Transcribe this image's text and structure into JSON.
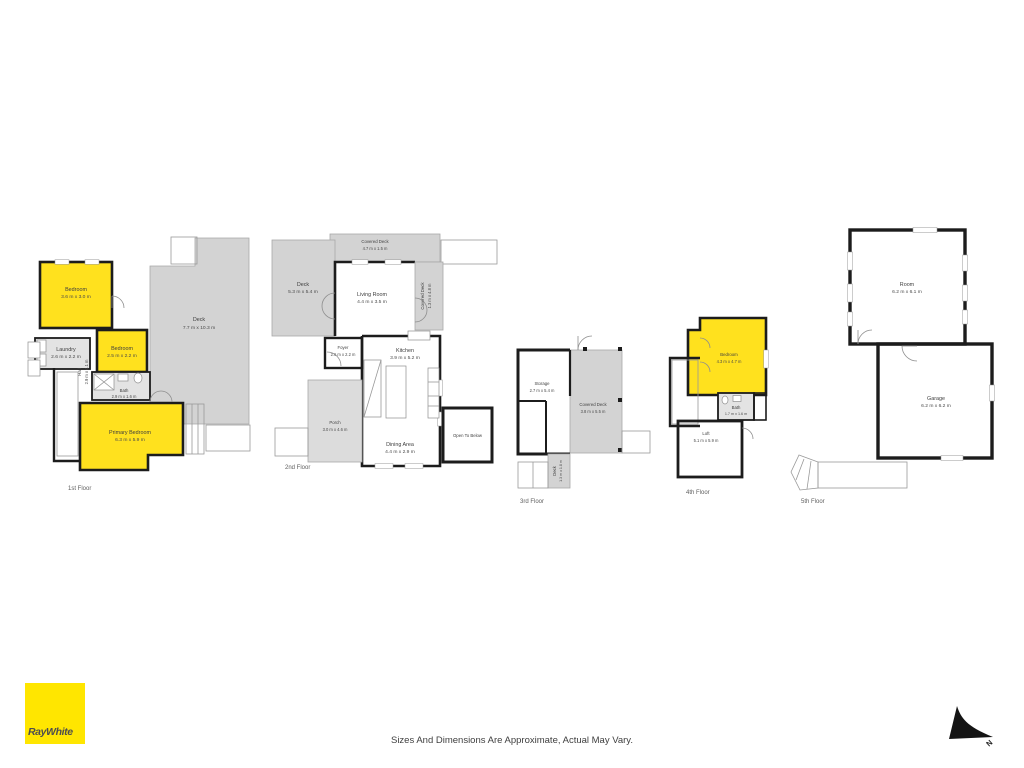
{
  "page": {
    "brand": "RayWhite",
    "disclaimer": "Sizes And Dimensions Are Approximate, Actual May Vary.",
    "north_label": "N",
    "colors": {
      "room_highlight": "#FFE11E",
      "deck_gray": "#D3D3D3",
      "wall_black": "#1C1C1C",
      "brand_yellow": "#FFE600",
      "brand_text": "#4D4D4F"
    }
  },
  "floors": [
    {
      "label": "1st Floor",
      "rooms": [
        {
          "name": "Bedroom",
          "dims": "3.6 m x 3.0 m"
        },
        {
          "name": "Deck",
          "dims": "7.7 m x 10.3 m"
        },
        {
          "name": "Laundry",
          "dims": "2.6 m x 2.2 m"
        },
        {
          "name": "Bedroom",
          "dims": "2.5 m x 2.2 m"
        },
        {
          "name": "Hall",
          "dims": "2.9 m x 4.1 m"
        },
        {
          "name": "Bath",
          "dims": "2.9 m x 1.6 m"
        },
        {
          "name": "Primary Bedroom",
          "dims": "6.3 m x 5.9 m"
        }
      ]
    },
    {
      "label": "2nd Floor",
      "rooms": [
        {
          "name": "Covered Deck",
          "dims": "4.7 m x 1.5 m"
        },
        {
          "name": "Deck",
          "dims": "5.3 m x 5.4 m"
        },
        {
          "name": "Living Room",
          "dims": "4.4 m x 3.5 m"
        },
        {
          "name": "Covered Deck",
          "dims": "1.3 m x 4.8 m"
        },
        {
          "name": "Foyer",
          "dims": "2.6 m x 2.2 m"
        },
        {
          "name": "Kitchen",
          "dims": "3.9 m x 5.2 m"
        },
        {
          "name": "Porch",
          "dims": "3.0 m x 4.6 m"
        },
        {
          "name": "Dining Area",
          "dims": "4.4 m x 2.9 m"
        },
        {
          "name": "Open To Below",
          "dims": ""
        }
      ]
    },
    {
      "label": "3rd Floor",
      "rooms": [
        {
          "name": "Storage",
          "dims": "2.7 m x 5.4 m"
        },
        {
          "name": "Covered Deck",
          "dims": "3.8 m x 5.5 m"
        },
        {
          "name": "Deck",
          "dims": "1.3 m x 1.8 m"
        }
      ]
    },
    {
      "label": "4th Floor",
      "rooms": [
        {
          "name": "Bedroom",
          "dims": "4.3 m x 4.7 m"
        },
        {
          "name": "Bath",
          "dims": "1.7 m x 1.6 m"
        },
        {
          "name": "Loft",
          "dims": "5.1 m x 5.9 m"
        }
      ]
    },
    {
      "label": "5th Floor",
      "rooms": [
        {
          "name": "Room",
          "dims": "6.2 m x 6.1 m"
        },
        {
          "name": "Garage",
          "dims": "6.2 m x 6.2 m"
        }
      ]
    }
  ]
}
